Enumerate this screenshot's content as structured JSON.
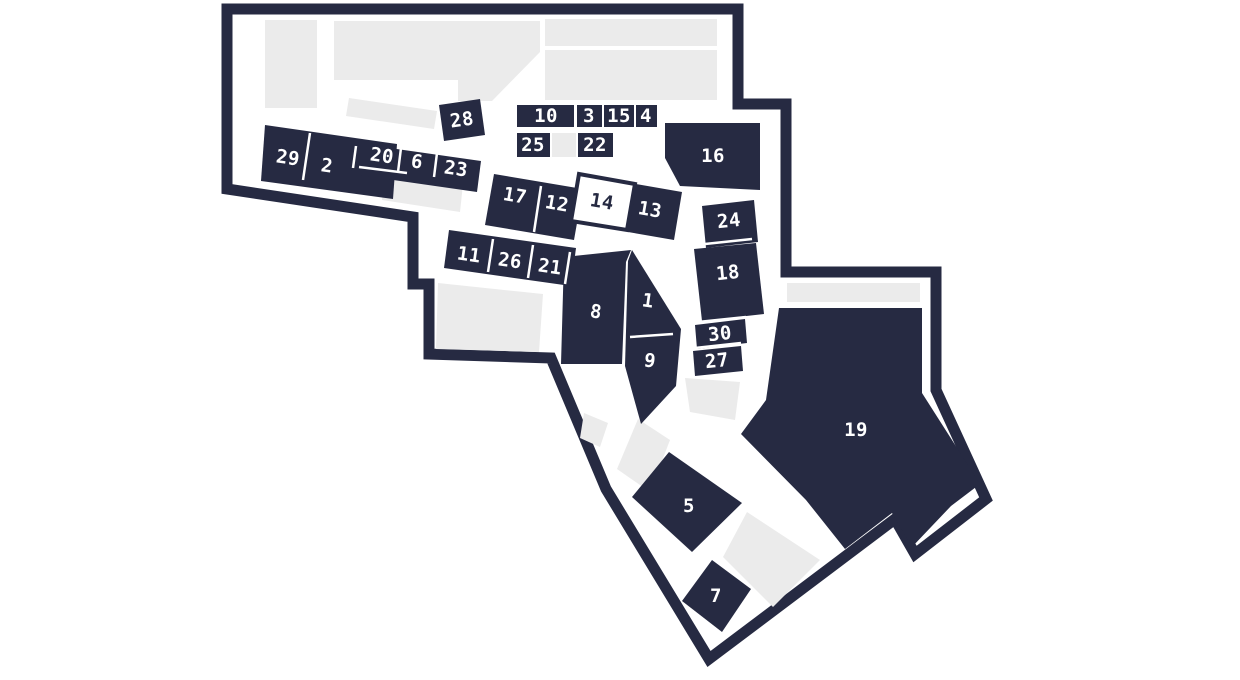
{
  "map": {
    "selected_unit": "14",
    "colors": {
      "unit_fill": "#262a42",
      "outline": "#262a42",
      "common_area": "#ebebeb",
      "selected_fill": "#ffffff",
      "label_text": "#ffffff"
    },
    "units": {
      "u1": "1",
      "u2": "2",
      "u3": "3",
      "u4": "4",
      "u5": "5",
      "u6": "6",
      "u7": "7",
      "u8": "8",
      "u9": "9",
      "u10": "10",
      "u11": "11",
      "u12": "12",
      "u13": "13",
      "u14": "14",
      "u15": "15",
      "u16": "16",
      "u17": "17",
      "u18": "18",
      "u19": "19",
      "u20": "20",
      "u21": "21",
      "u22": "22",
      "u23": "23",
      "u24": "24",
      "u25": "25",
      "u26": "26",
      "u27": "27",
      "u28": "28",
      "u29": "29",
      "u30": "30"
    }
  }
}
